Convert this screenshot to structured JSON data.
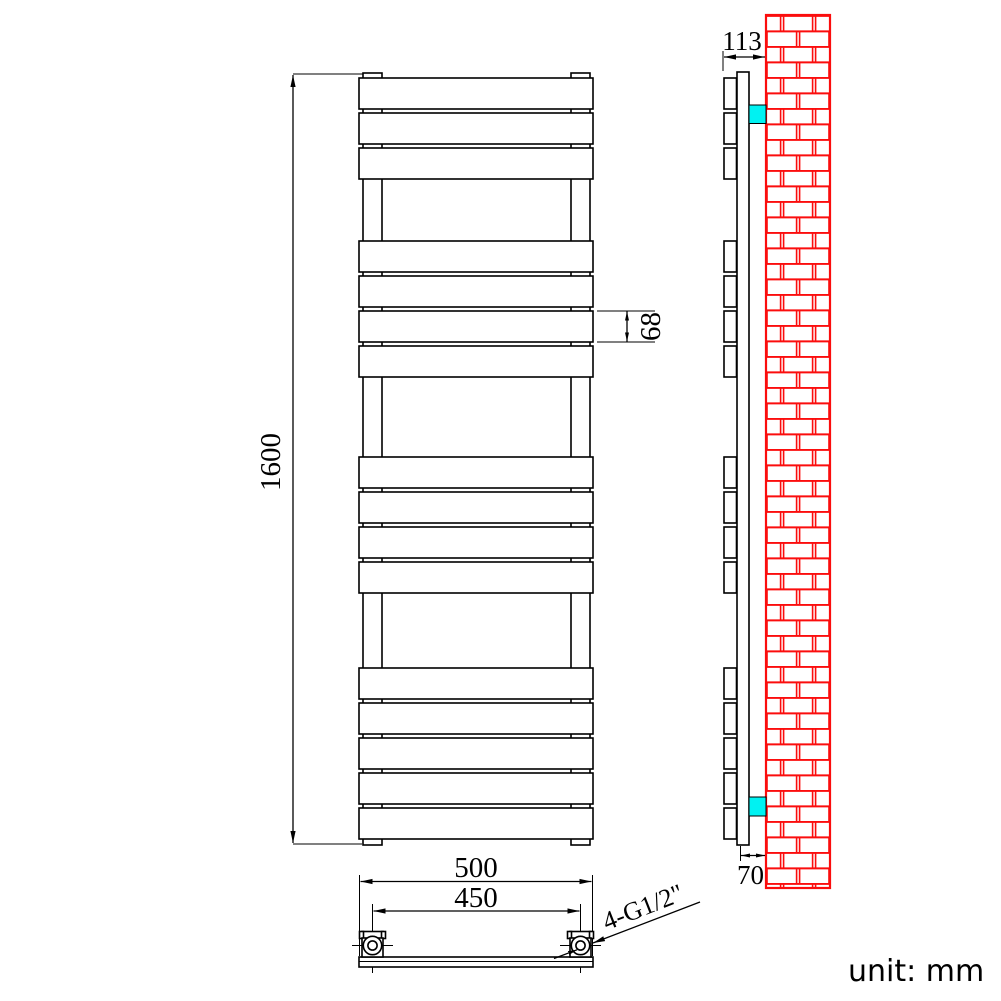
{
  "drawing": {
    "unit_label": "unit: mm",
    "dimensions": {
      "overall_height": "1600",
      "panel_height": "68",
      "overall_width": "500",
      "connection_centres": "450",
      "connections_label": "4-G1/2\"",
      "overall_depth": "113",
      "wall_clearance": "70"
    },
    "radiator": {
      "bar_groups": [
        3,
        4,
        4,
        5
      ],
      "total_bars": 16
    },
    "colors": {
      "line": "#000000",
      "brick_red": "#fb0d0d",
      "bracket_cyan": "#00f2f2",
      "part_fill": "#ffffff"
    }
  }
}
